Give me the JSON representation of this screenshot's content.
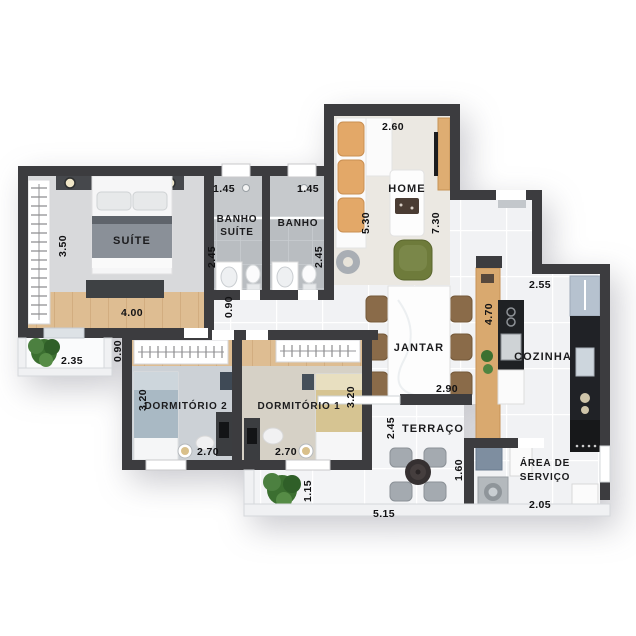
{
  "palette": {
    "wall": "#3c3c3f",
    "wood_floor": "#debd92",
    "wood_furniture": "#d9a96f",
    "tile_light": "#f1f2f4",
    "tile_bath": "#b9bdc1",
    "counter_black": "#202226",
    "plant_green": "#3f7134",
    "armchair_green": "#6e7b3b",
    "cushion_tan": "#e3a868"
  },
  "rooms": {
    "suite": {
      "label": "SUÍTE",
      "dim_width": "4.00",
      "dim_depth": "3.50"
    },
    "varanda_suite": {
      "dim_width": "2.35",
      "dim_depth": "0.90"
    },
    "banho_suite": {
      "label_line1": "BANHO",
      "label_line2": "SUÍTE",
      "dim_width": "1.45",
      "dim_depth": "2.45"
    },
    "banho": {
      "label": "BANHO",
      "dim_width": "1.45",
      "dim_depth": "2.45"
    },
    "hall": {
      "dim_width": "0.90"
    },
    "home": {
      "label": "HOME",
      "dim_width": "2.60",
      "dim_depth_left": "5.30",
      "dim_depth_right": "7.30"
    },
    "jantar": {
      "label": "JANTAR",
      "dim_width": "2.90",
      "dim_counter": "4.70"
    },
    "cozinha": {
      "label": "COZINHA",
      "dim_width": "2.55"
    },
    "dormitorio2": {
      "label": "DORMITÓRIO 2",
      "dim_width": "2.70",
      "dim_depth": "3.20"
    },
    "dormitorio1": {
      "label": "DORMITÓRIO 1",
      "dim_width": "2.70",
      "dim_depth": "3.20"
    },
    "terraco": {
      "label": "TERRAÇO",
      "dim_width": "5.15",
      "dim_depth": "2.45",
      "dim_depth_right": "1.60",
      "dim_side": "1.15"
    },
    "area_servico": {
      "label_line1": "ÁREA DE",
      "label_line2": "SERVIÇO",
      "dim_width": "2.05"
    }
  }
}
